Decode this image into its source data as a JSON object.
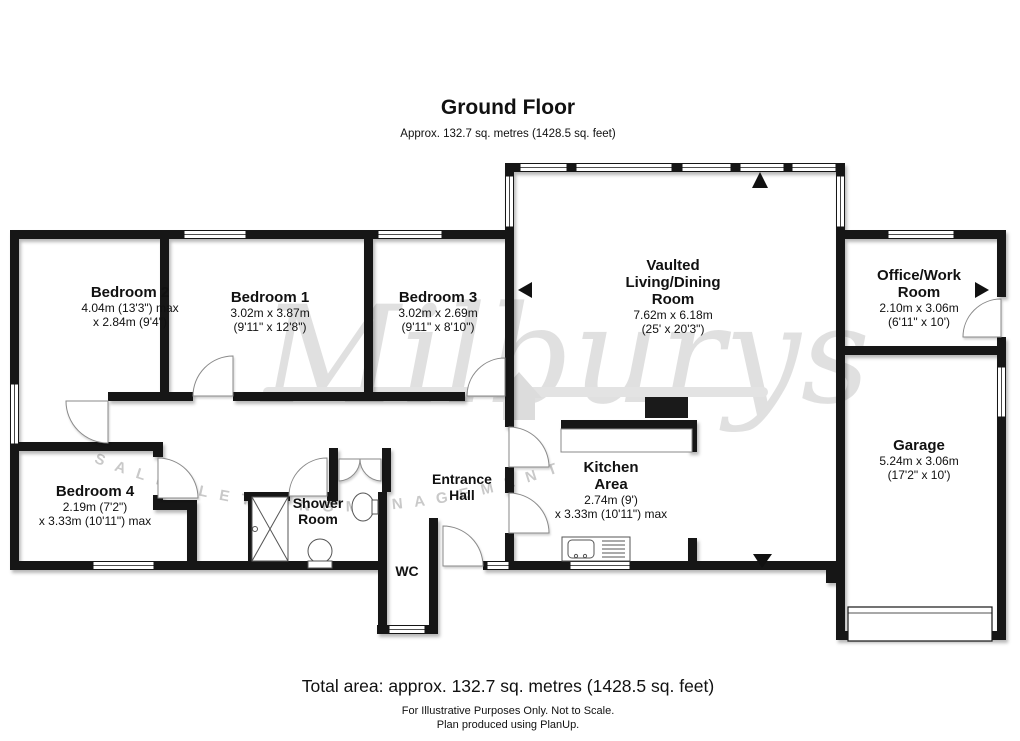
{
  "header": {
    "title": "Ground Floor",
    "subtitle": "Approx. 132.7 sq. metres (1428.5 sq. feet)"
  },
  "rooms": {
    "bedroom2": {
      "name": "Bedroom 2",
      "dim1": "4.04m (13'3\") max",
      "dim2": "x 2.84m (9'4\")"
    },
    "bedroom1": {
      "name": "Bedroom 1",
      "dim1": "3.02m x 3.87m",
      "dim2": "(9'11\" x 12'8\")"
    },
    "bedroom3": {
      "name": "Bedroom 3",
      "dim1": "3.02m x 2.69m",
      "dim2": "(9'11\" x 8'10\")"
    },
    "living": {
      "name1": "Vaulted",
      "name2": "Living/Dining",
      "name3": "Room",
      "dim1": "7.62m x 6.18m",
      "dim2": "(25' x 20'3\")"
    },
    "office": {
      "name1": "Office/Work",
      "name2": "Room",
      "dim1": "2.10m x 3.06m",
      "dim2": "(6'11\" x 10')"
    },
    "garage": {
      "name": "Garage",
      "dim1": "5.24m x 3.06m",
      "dim2": "(17'2\" x 10')"
    },
    "bedroom4": {
      "name": "Bedroom 4",
      "dim1": "2.19m (7'2\")",
      "dim2": "x 3.33m (10'11\") max"
    },
    "shower": {
      "name1": "Shower",
      "name2": "Room"
    },
    "entrance": {
      "name1": "Entrance",
      "name2": "Hall"
    },
    "wc": {
      "name": "WC"
    },
    "kitchen": {
      "name1": "Kitchen",
      "name2": "Area",
      "dim1": "2.74m (9')",
      "dim2": "x 3.33m (10'11\") max"
    }
  },
  "watermark": {
    "brand": "Milburys",
    "tagline": "S A L E S   L E T T I N G   M A N A G E M E N T"
  },
  "footer": {
    "total": "Total area: approx. 132.7 sq. metres (1428.5 sq. feet)",
    "line1": "For Illustrative Purposes Only. Not to Scale.",
    "line2": "Plan produced using PlanUp."
  },
  "colors": {
    "wall": "#161616",
    "fixture": "#555555",
    "watermark_text": "#c9c9c9"
  }
}
